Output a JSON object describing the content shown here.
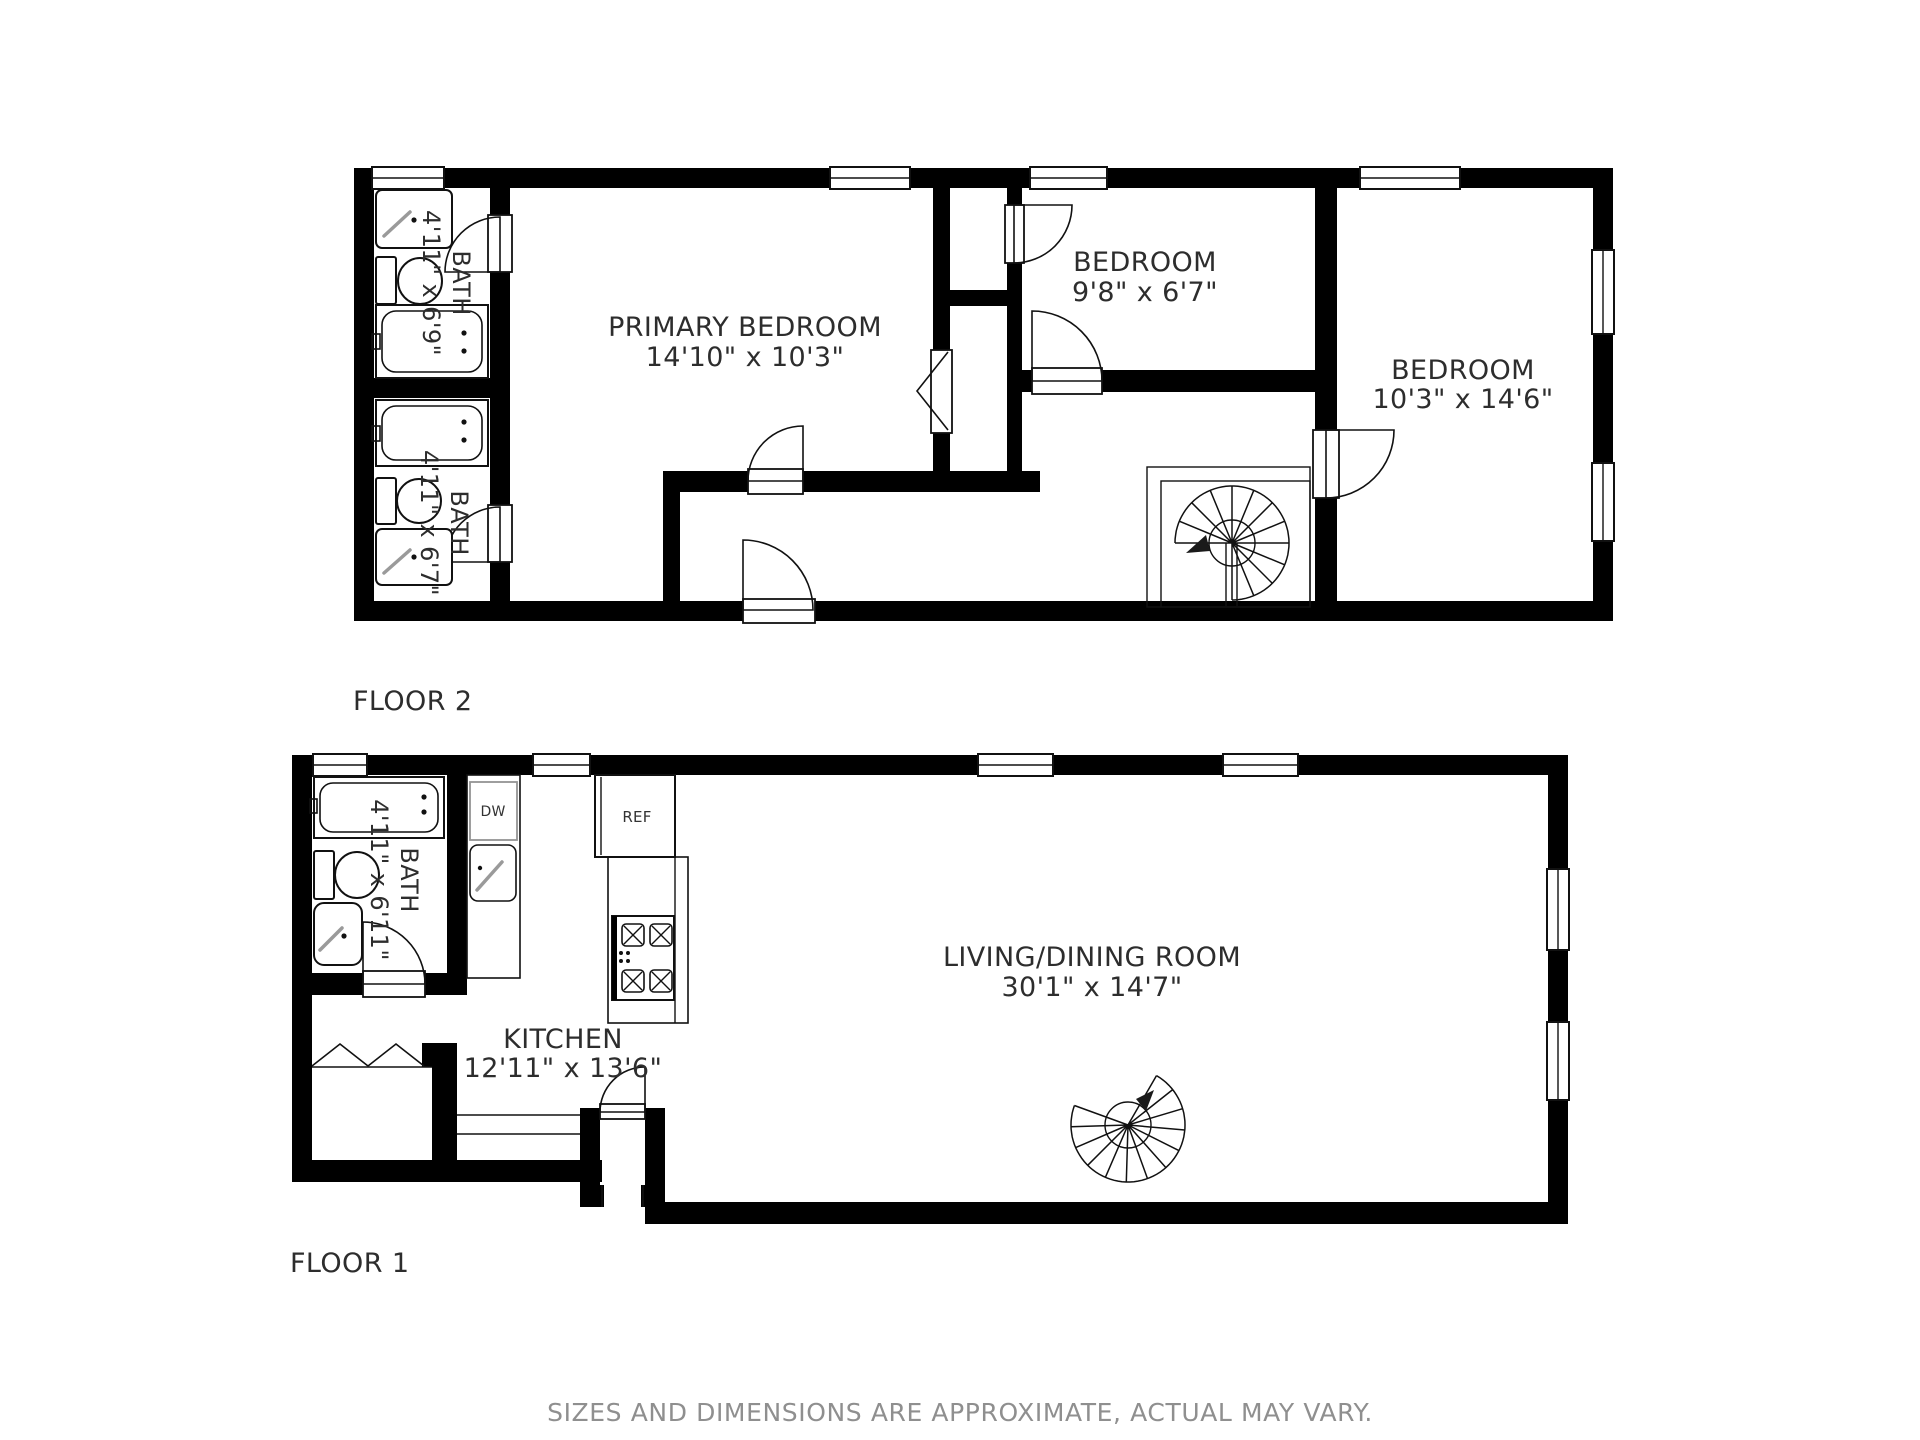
{
  "floor2": {
    "label": "FLOOR 2",
    "primary_bedroom": {
      "name": "PRIMARY BEDROOM",
      "dims": "14'10\" x 10'3\""
    },
    "bedroom_small": {
      "name": "BEDROOM",
      "dims": "9'8\" x 6'7\""
    },
    "bedroom_large": {
      "name": "BEDROOM",
      "dims": "10'3\" x 14'6\""
    },
    "bath_top": {
      "name": "BATH",
      "dims": "4'11\" x 6'9\""
    },
    "bath_bottom": {
      "name": "BATH",
      "dims": "4'11\" x 6'7\""
    }
  },
  "floor1": {
    "label": "FLOOR 1",
    "living_dining": {
      "name": "LIVING/DINING ROOM",
      "dims": "30'1\" x 14'7\""
    },
    "kitchen": {
      "name": "KITCHEN",
      "dims": "12'11\" x 13'6\""
    },
    "bath": {
      "name": "BATH",
      "dims": "4'11\" x 6'11\""
    },
    "dishwasher_label": "DW",
    "refrigerator_label": "REF"
  },
  "footer": {
    "disclaimer": "SIZES AND DIMENSIONS ARE APPROXIMATE, ACTUAL MAY VARY."
  }
}
